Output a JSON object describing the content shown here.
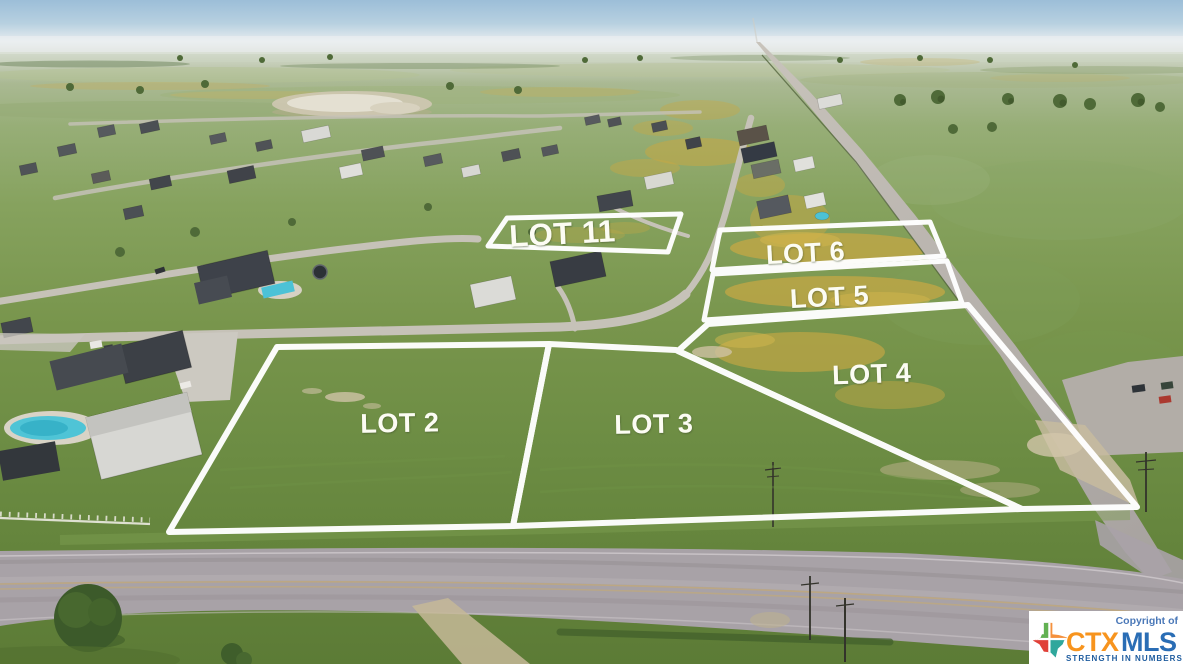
{
  "lots": [
    {
      "id": "lot-11",
      "label": "LOT 11"
    },
    {
      "id": "lot-6",
      "label": "LOT 6"
    },
    {
      "id": "lot-5",
      "label": "LOT 5"
    },
    {
      "id": "lot-4",
      "label": "LOT 4"
    },
    {
      "id": "lot-2",
      "label": "LOT 2"
    },
    {
      "id": "lot-3",
      "label": "LOT 3"
    }
  ],
  "watermark": {
    "copyright": "Copyright of",
    "brand_ctx": "CTX",
    "brand_mls": "MLS",
    "tagline": "STRENGTH IN NUMBERS"
  },
  "colors": {
    "lot_boundary": "#ffffff",
    "brand_orange": "#f7941e",
    "brand_blue": "#2a6db5",
    "tagline_blue": "#1d5b9e",
    "copyright_blue": "#4a78b8",
    "texas_green": "#62b152",
    "texas_orange": "#f5913d",
    "texas_red": "#e04038",
    "texas_teal": "#2fa79c"
  }
}
